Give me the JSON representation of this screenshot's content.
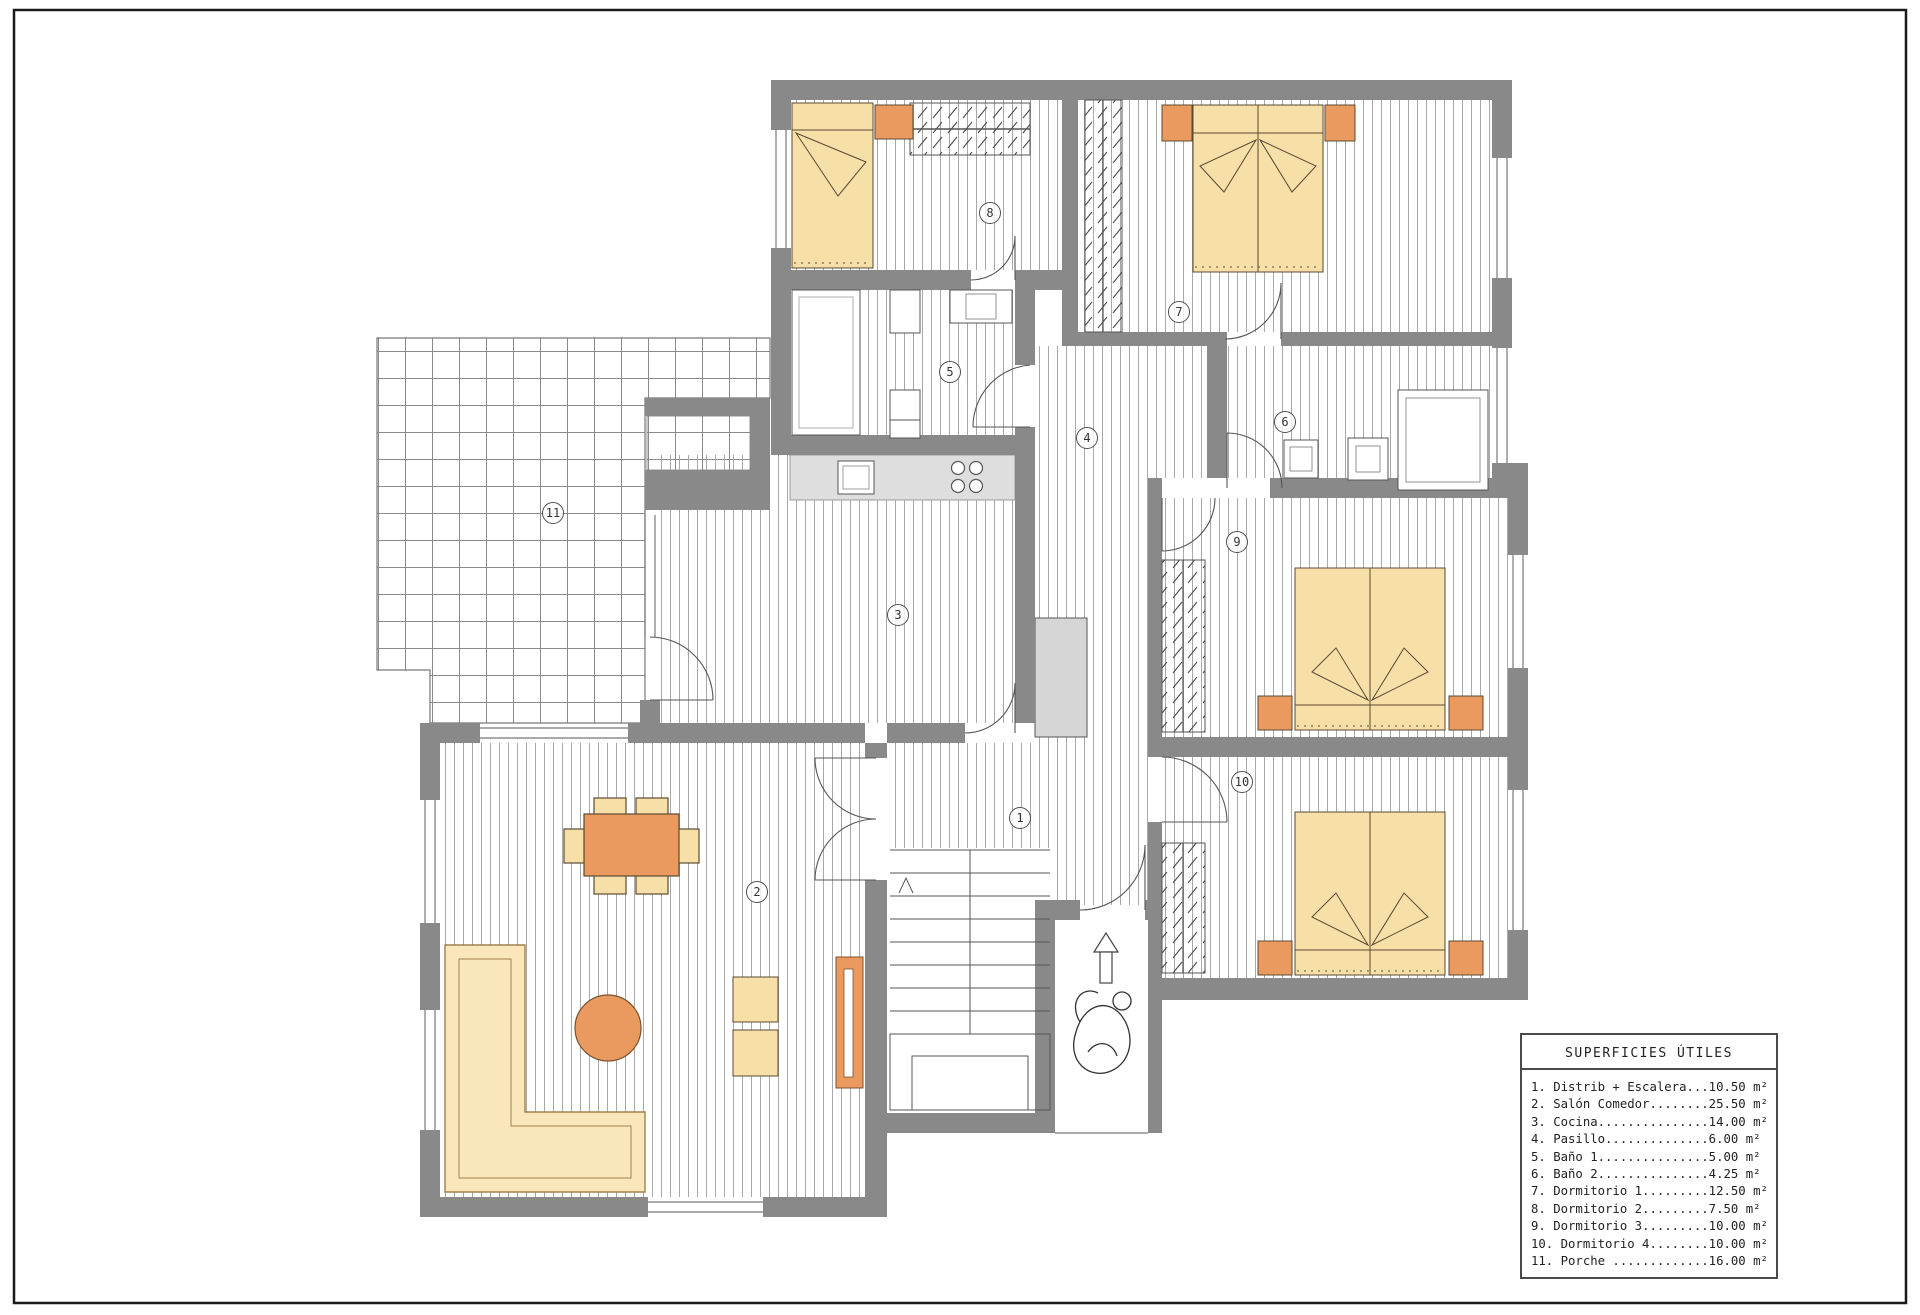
{
  "document": {
    "type": "architectural floor plan",
    "language": "Spanish"
  },
  "legend": {
    "title": "SUPERFICIES ÚTILES",
    "items": [
      "1. Distrib + Escalera...10.50 m²",
      "2. Salón Comedor........25.50 m²",
      "3. Cocina...............14.00 m²",
      "4. Pasillo..............6.00 m²",
      "5. Baño 1...............5.00 m²",
      "6. Baño 2...............4.25 m²",
      "7. Dormitorio 1.........12.50 m²",
      "8. Dormitorio 2.........7.50 m²",
      "9. Dormitorio 3.........10.00 m²",
      "10. Dormitorio 4........10.00 m²",
      "11. Porche .............16.00 m²"
    ]
  },
  "rooms": [
    {
      "num": "1",
      "name": "Distrib + Escalera",
      "area_m2": "10.50",
      "x": 1020,
      "y": 818
    },
    {
      "num": "2",
      "name": "Salón Comedor",
      "area_m2": "25.50",
      "x": 757,
      "y": 892
    },
    {
      "num": "3",
      "name": "Cocina",
      "area_m2": "14.00",
      "x": 898,
      "y": 615
    },
    {
      "num": "4",
      "name": "Pasillo",
      "area_m2": "6.00",
      "x": 1087,
      "y": 438
    },
    {
      "num": "5",
      "name": "Baño 1",
      "area_m2": "5.00",
      "x": 950,
      "y": 372
    },
    {
      "num": "6",
      "name": "Baño 2",
      "area_m2": "4.25",
      "x": 1285,
      "y": 422
    },
    {
      "num": "7",
      "name": "Dormitorio 1",
      "area_m2": "12.50",
      "x": 1179,
      "y": 312
    },
    {
      "num": "8",
      "name": "Dormitorio 2",
      "area_m2": "7.50",
      "x": 990,
      "y": 213
    },
    {
      "num": "9",
      "name": "Dormitorio 3",
      "area_m2": "10.00",
      "x": 1237,
      "y": 542
    },
    {
      "num": "10",
      "name": "Dormitorio 4",
      "area_m2": "10.00",
      "x": 1242,
      "y": 782
    },
    {
      "num": "11",
      "name": "Porche",
      "area_m2": "16.00",
      "x": 553,
      "y": 513
    }
  ],
  "colors": {
    "wall": "#898989",
    "floor_hatch_line": "#a8a8a8",
    "tile_line": "#8a8a8a",
    "furniture_cream": "#f7dfa8",
    "furniture_orange": "#ea9a5e",
    "furniture_outline": "#5b4a33",
    "counter_gray": "#dedede",
    "shaft_gray": "#d6d6d6",
    "line_dark": "#4f4f4f"
  },
  "icons": {
    "entry_arrow": "up-arrow-icon",
    "stairs_direction": "up-triangle-icon",
    "person": "person-sketch-icon"
  }
}
